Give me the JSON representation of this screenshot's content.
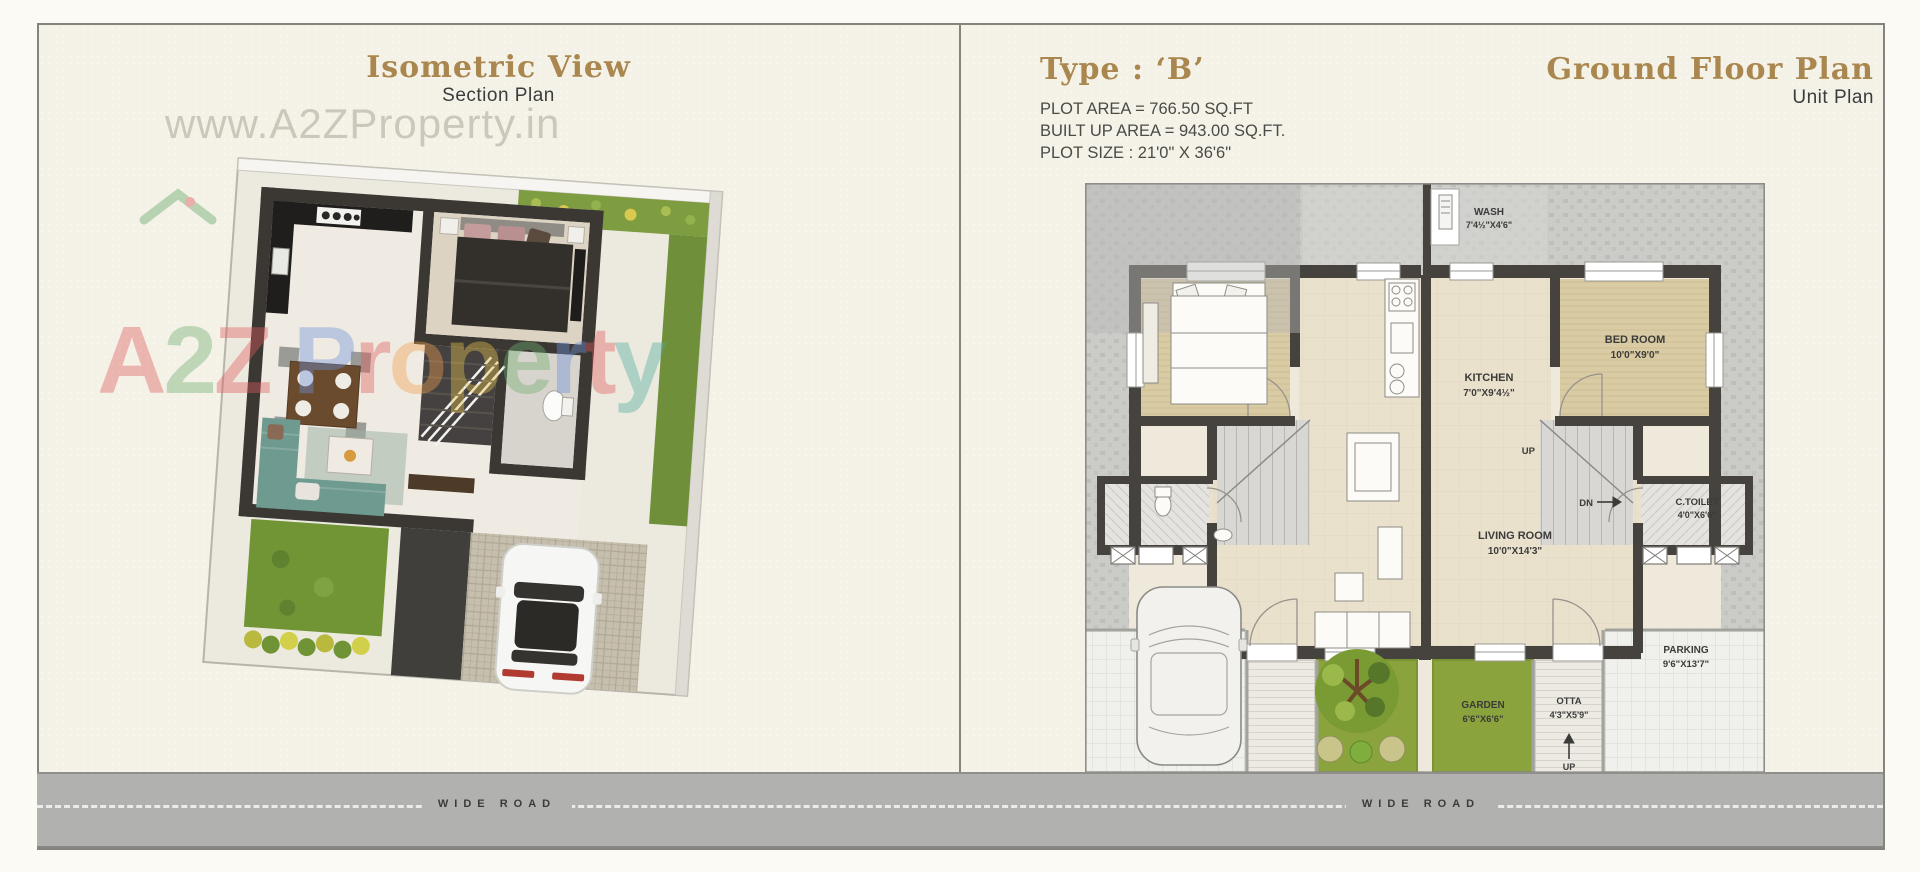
{
  "left_panel": {
    "title": "Isometric View",
    "subtitle": "Section Plan",
    "road_label": "WIDE ROAD"
  },
  "right_panel": {
    "title": "Type : ‘B’",
    "info_lines": [
      "PLOT AREA = 766.50 SQ.FT",
      "BUILT UP AREA = 943.00 SQ.FT.",
      "PLOT SIZE : 21'0\" X 36'6\""
    ],
    "plan_title": "Ground Floor Plan",
    "plan_subtitle": "Unit Plan",
    "road_label": "WIDE ROAD",
    "rooms": {
      "wash": {
        "name": "WASH",
        "dims": "7'4½\"X4'6\""
      },
      "bedroom": {
        "name": "BED ROOM",
        "dims": "10'0\"X9'0\""
      },
      "kitchen": {
        "name": "KITCHEN",
        "dims": "7'0\"X9'4½\""
      },
      "ctoilet": {
        "name": "C.TOILET",
        "dims": "4'0\"X6'6\""
      },
      "living": {
        "name": "LIVING ROOM",
        "dims": "10'0\"X14'3\""
      },
      "garden": {
        "name": "GARDEN",
        "dims": "6'6\"X6'6\""
      },
      "otta": {
        "name": "OTTA",
        "dims": "4'3\"X5'9\""
      },
      "parking": {
        "name": "PARKING",
        "dims": "9'6\"X13'7\""
      }
    },
    "stairs": {
      "up": "UP",
      "dn": "DN",
      "entry_up": "UP"
    }
  },
  "watermark": {
    "url_text": "www.A2ZProperty.in",
    "logo_letters": [
      {
        "ch": "A",
        "color": "#e05c5c"
      },
      {
        "ch": "2",
        "color": "#6fae6f"
      },
      {
        "ch": "Z",
        "color": "#e05c5c"
      },
      {
        "ch": " ",
        "color": "#000000"
      },
      {
        "ch": "P",
        "color": "#6f92dc"
      },
      {
        "ch": "r",
        "color": "#e05c5c"
      },
      {
        "ch": "o",
        "color": "#ef9d4f"
      },
      {
        "ch": "p",
        "color": "#e8c44c"
      },
      {
        "ch": "e",
        "color": "#6fae6f"
      },
      {
        "ch": "r",
        "color": "#6f92dc"
      },
      {
        "ch": "t",
        "color": "#e05c5c"
      },
      {
        "ch": "y",
        "color": "#4fae9d"
      }
    ]
  },
  "colors": {
    "background": "#f4f1e7",
    "gold": "#a9874e",
    "wall_dark": "#46423e",
    "floor_beige": "#eae1cd",
    "floor_tan": "#d9cba4",
    "garden_green": "#8ba33c",
    "road_gray": "#b1b1af",
    "hatch_gray": "#cbcbc8",
    "sofa_teal": "#6f9a90"
  }
}
